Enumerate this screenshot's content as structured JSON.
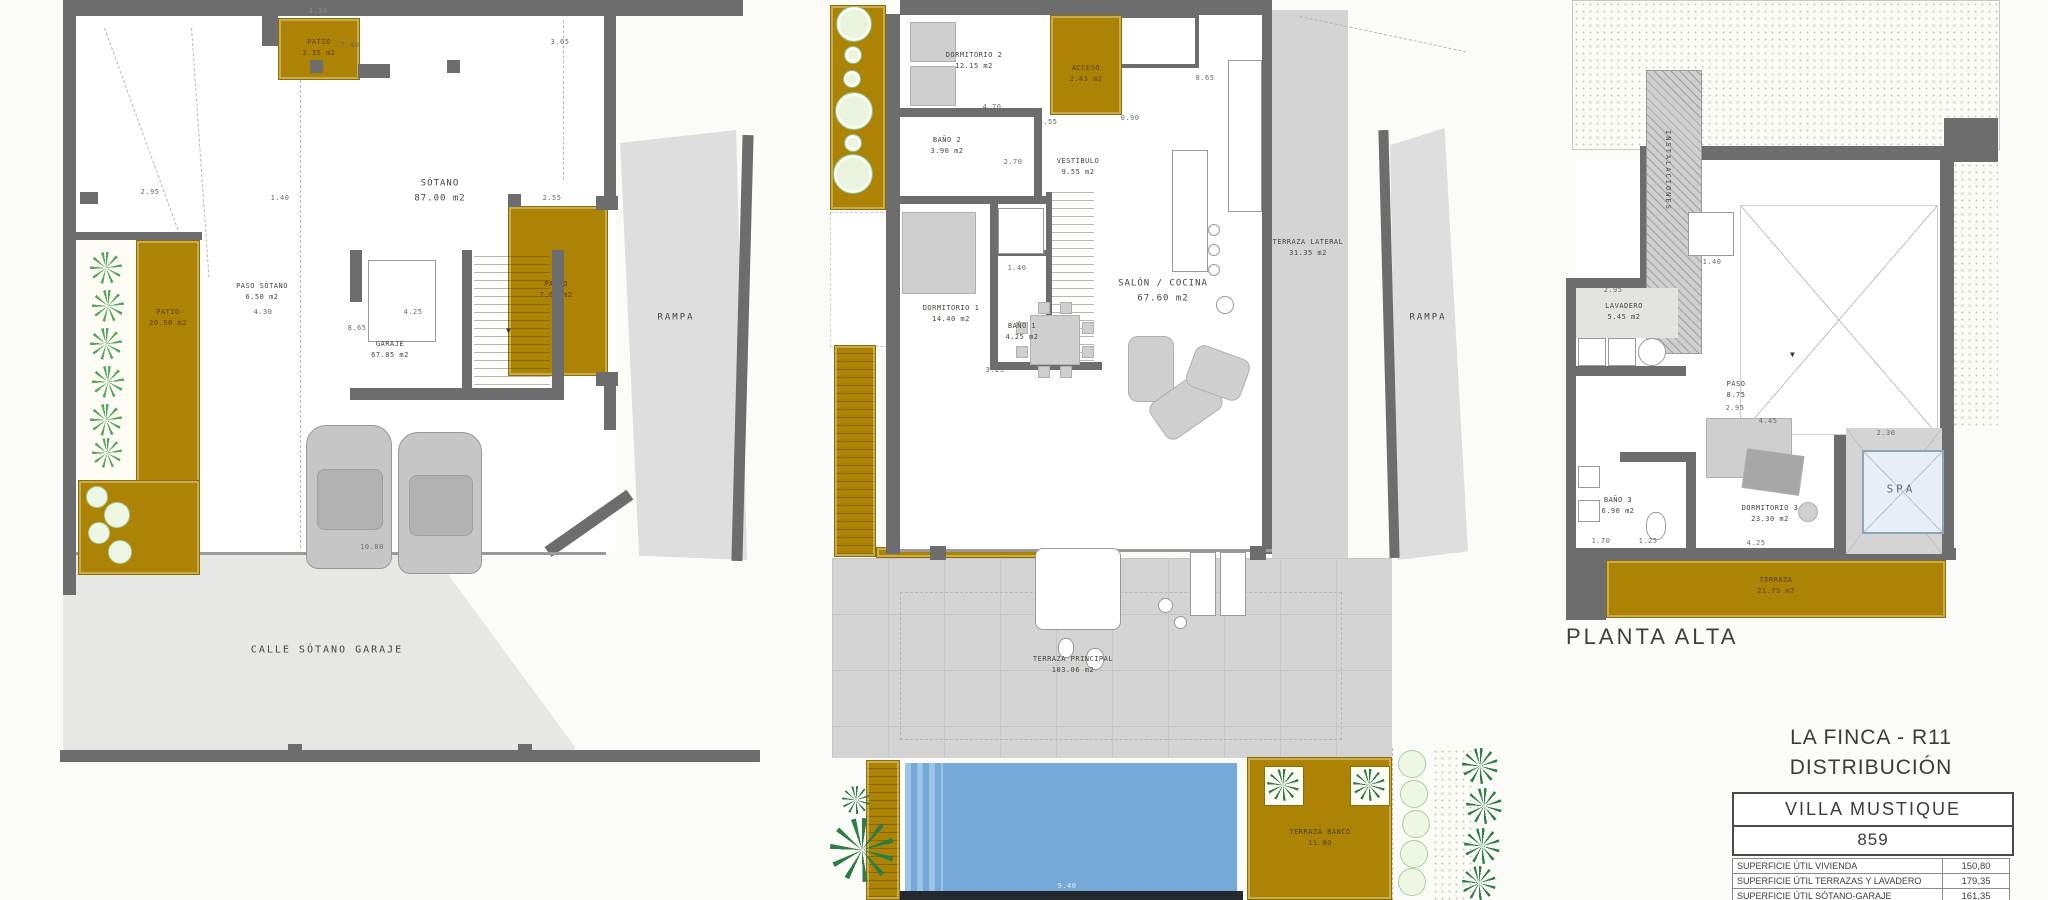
{
  "colors": {
    "gold": "#ad8306",
    "wall_gray": "#6d6d6d",
    "terrace_gray": "#d4d4d4",
    "ramp_gray": "#e2e2df",
    "pool_blue": "#74a9d8",
    "plant_green": "#56a65c",
    "palm_green": "#2e7d44"
  },
  "plans": {
    "basement": {
      "rooms": {
        "patio_top": {
          "name": "PATIO",
          "area": "3.35 m2"
        },
        "sotano": {
          "name": "SÓTANO",
          "area": "87.00 m2"
        },
        "paso_sotano": {
          "name": "PASO SÓTANO",
          "area": "6.50 m2"
        },
        "patio_left": {
          "name": "PATIO",
          "area": "20.50 m2"
        },
        "patio_right": {
          "name": "PATIO",
          "area": "7.60 m2"
        },
        "garaje": {
          "name": "GARAJE",
          "area": "67.85 m2"
        }
      },
      "street": "CALLE SÓTANO GARAJE",
      "ramp": "RAMPA",
      "dims": [
        "7.40",
        "3.30",
        "3.65",
        "2.95",
        "1.40",
        "4.30",
        "4.25",
        "8.65",
        "2.55",
        "10.00"
      ]
    },
    "ground": {
      "rooms": {
        "dormitorio2": {
          "name": "DORMITORIO 2",
          "area": "12.15 m2"
        },
        "bano2": {
          "name": "BAÑO 2",
          "area": "3.90 m2"
        },
        "acceso": {
          "name": "ACCESO",
          "area": "2.43 m2"
        },
        "vestibulo": {
          "name": "VESTÍBULO",
          "area": "9.55 m2"
        },
        "dormitorio1": {
          "name": "DORMITORIO 1",
          "area": "14.40 m2"
        },
        "bano1": {
          "name": "BAÑO 1",
          "area": "4.25 m2"
        },
        "salon": {
          "name": "SALÓN / COCINA",
          "area": "67.60 m2"
        },
        "terraza_lateral": {
          "name": "TERRAZA LATERAL",
          "area": "31.35 m2"
        },
        "terraza_principal": {
          "name": "TERRAZA PRINCIPAL",
          "area": "103.06 m2"
        },
        "terraza_banco": {
          "name": "TERRAZA BANCO",
          "area": "11.80"
        }
      },
      "ramp": "RAMPA",
      "dims": [
        "4.70",
        "3.55",
        "0.90",
        "8.65",
        "2.70",
        "1.40",
        "3.25",
        "9.40"
      ]
    },
    "upper": {
      "label": "PLANTA ALTA",
      "rooms": {
        "instalaciones": {
          "name": "INSTALACIONES"
        },
        "lavadero": {
          "name": "LAVADERO",
          "area": "5.45 m2"
        },
        "paso": {
          "name": "PASO",
          "area": "8.75"
        },
        "bano3": {
          "name": "BAÑO 3",
          "area": "6.90 m2"
        },
        "dormitorio3": {
          "name": "DORMITORIO 3",
          "area": "23.30 m2"
        },
        "spa": {
          "name": "SPA"
        },
        "terraza": {
          "name": "TERRAZA",
          "area": "21.75 m2"
        }
      },
      "dims": [
        "2.95",
        "1.40",
        "4.45",
        "2.30",
        "4.25",
        "1.70",
        "1.25",
        "2.95"
      ]
    }
  },
  "title_block": {
    "project": "LA FINCA - R11",
    "drawing": "DISTRIBUCIÓN",
    "villa_name": "VILLA  MUSTIQUE",
    "villa_number": "859",
    "areas_table": {
      "rows": [
        {
          "label": "SUPERFICIE ÚTIL VIVIENDA",
          "value": "150,80"
        },
        {
          "label": "SUPERFICIE ÚTIL TERRAZAS Y LAVADERO",
          "value": "179,35"
        },
        {
          "label": "SUPERFICIE ÚTIL SÓTANO-GARAJE",
          "value": "161,35"
        }
      ]
    }
  }
}
